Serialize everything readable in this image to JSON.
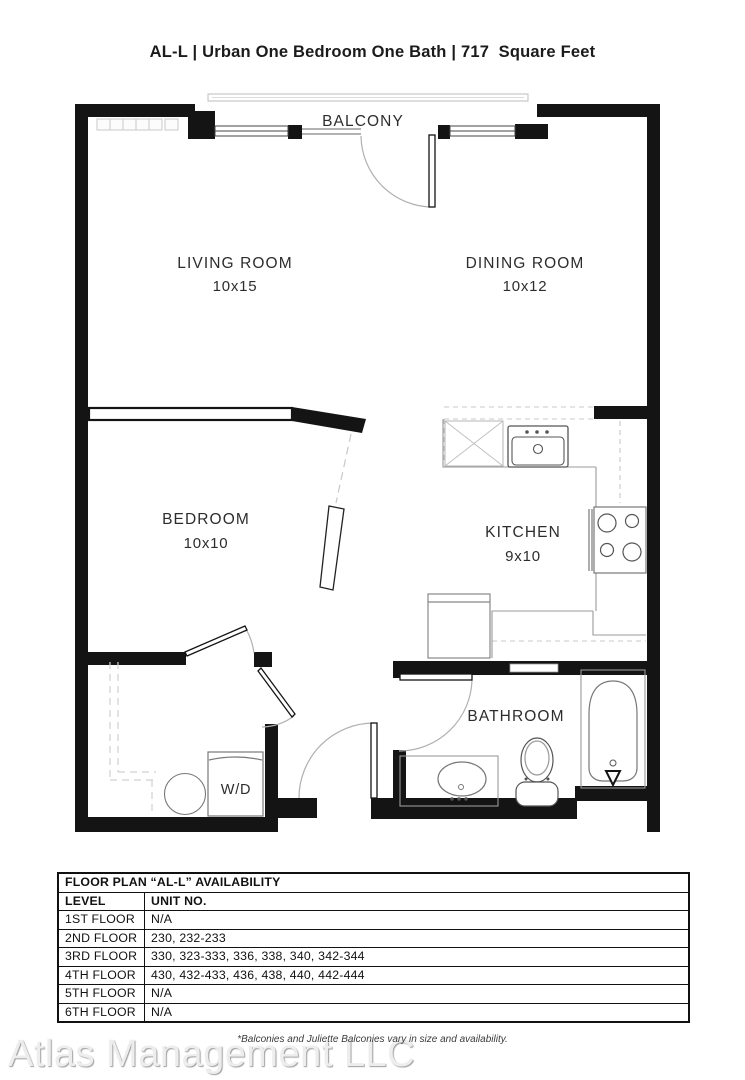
{
  "title": "AL-L | Urban One Bedroom One Bath | 717  Square Feet",
  "floor_plan": {
    "balcony_label": "BALCONY",
    "rooms": {
      "living": {
        "name": "LIVING ROOM",
        "dims": "10x15"
      },
      "dining": {
        "name": "DINING ROOM",
        "dims": "10x12"
      },
      "bedroom": {
        "name": "BEDROOM",
        "dims": "10x10"
      },
      "kitchen": {
        "name": "KITCHEN",
        "dims": "9x10"
      },
      "bathroom": {
        "name": "BATHROOM"
      },
      "washer_dryer": {
        "label": "W/D"
      }
    }
  },
  "availability": {
    "title": "FLOOR PLAN “AL-L” AVAILABILITY",
    "columns": {
      "level": "LEVEL",
      "unit": "UNIT NO."
    },
    "rows": [
      {
        "level": "1ST FLOOR",
        "units": "N/A"
      },
      {
        "level": "2ND FLOOR",
        "units": "230, 232-233"
      },
      {
        "level": "3RD FLOOR",
        "units": "330, 323-333, 336, 338, 340, 342-344"
      },
      {
        "level": "4TH FLOOR",
        "units": "430, 432-433, 436, 438, 440, 442-444"
      },
      {
        "level": "5TH FLOOR",
        "units": "N/A"
      },
      {
        "level": "6TH FLOOR",
        "units": "N/A"
      }
    ]
  },
  "footnote": "*Balconies and Juliette Balconies vary in size and availability.",
  "watermark": "Atlas Management LLC",
  "colors": {
    "wall": "#141414",
    "fixture_line": "#8c8c8c",
    "text": "#2d2d2d",
    "watermark": "#ededed"
  }
}
